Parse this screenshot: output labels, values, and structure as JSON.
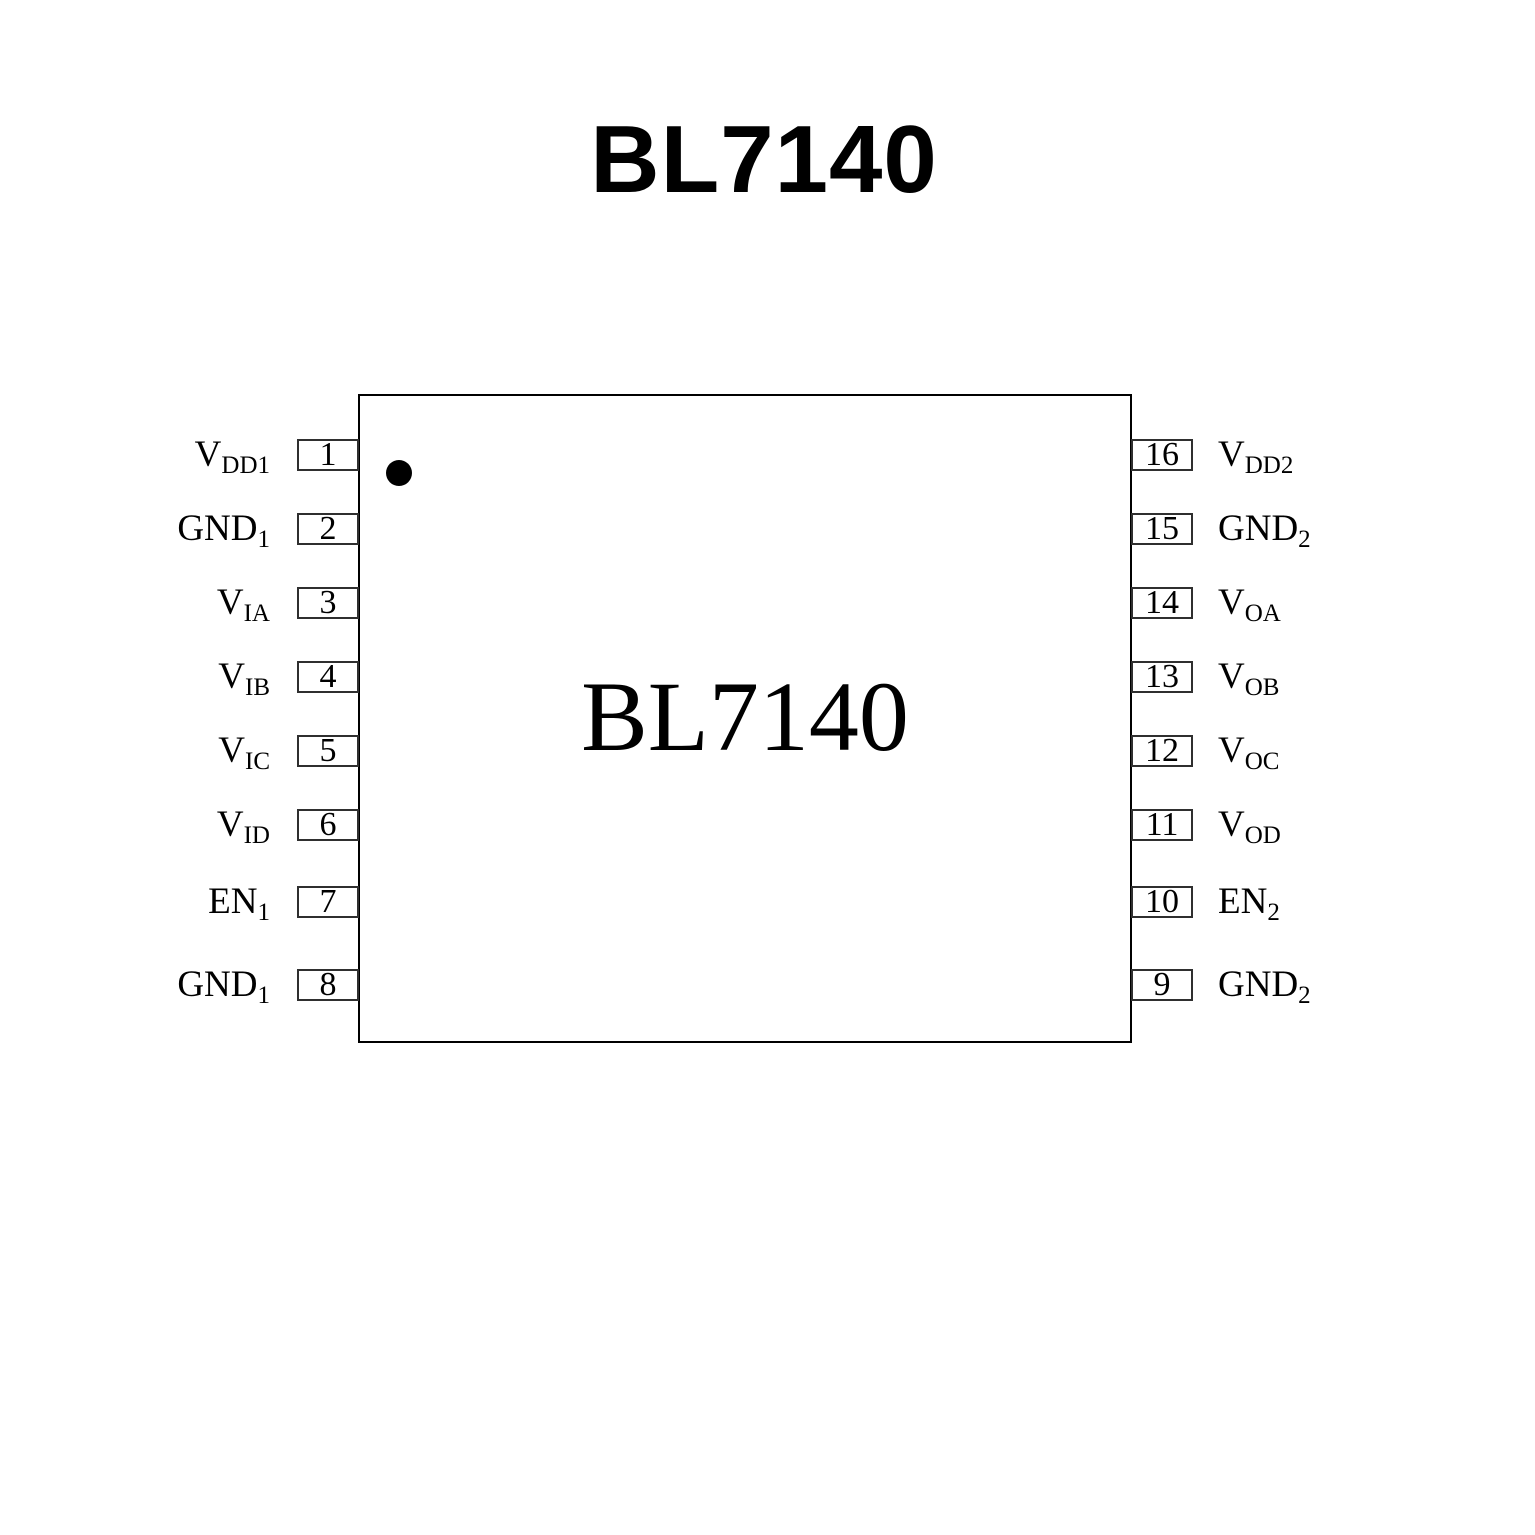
{
  "title": "BL7140",
  "chip": {
    "label": "BL7140"
  },
  "pins": {
    "left": [
      {
        "number": "1",
        "base": "V",
        "sub": "DD1"
      },
      {
        "number": "2",
        "base": "GND",
        "sub": "1"
      },
      {
        "number": "3",
        "base": "V",
        "sub": "IA"
      },
      {
        "number": "4",
        "base": "V",
        "sub": "IB"
      },
      {
        "number": "5",
        "base": "V",
        "sub": "IC"
      },
      {
        "number": "6",
        "base": "V",
        "sub": "ID"
      },
      {
        "number": "7",
        "base": "EN",
        "sub": "1"
      },
      {
        "number": "8",
        "base": "GND",
        "sub": "1"
      }
    ],
    "right": [
      {
        "number": "16",
        "base": "V",
        "sub": "DD2"
      },
      {
        "number": "15",
        "base": "GND",
        "sub": "2"
      },
      {
        "number": "14",
        "base": "V",
        "sub": "OA"
      },
      {
        "number": "13",
        "base": "V",
        "sub": "OB"
      },
      {
        "number": "12",
        "base": "V",
        "sub": "OC"
      },
      {
        "number": "11",
        "base": "V",
        "sub": "OD"
      },
      {
        "number": "10",
        "base": "EN",
        "sub": "2"
      },
      {
        "number": "9",
        "base": "GND",
        "sub": "2"
      }
    ]
  },
  "colors": {
    "ink": "#000000",
    "chip_border": "#000000",
    "pin_box_border": "#2f2f2f",
    "background": "#ffffff"
  }
}
